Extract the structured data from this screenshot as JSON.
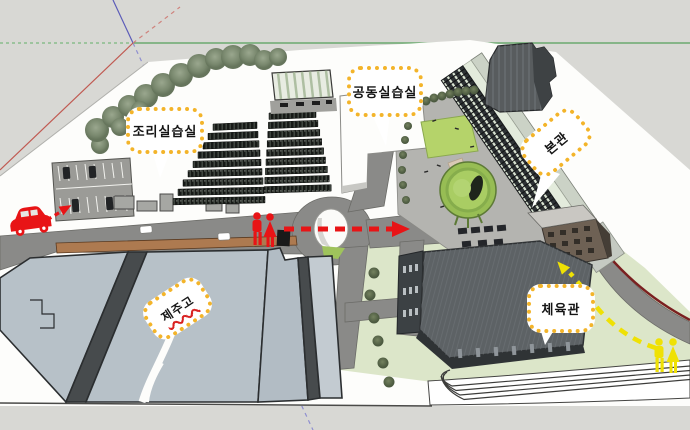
{
  "callouts": {
    "cooking_lab": {
      "label": "조리실습실"
    },
    "joint_lab": {
      "label": "공동실습실"
    },
    "main_building": {
      "label": "본관"
    },
    "jeju_high": {
      "label": "제주고"
    },
    "gym": {
      "label": "체육관"
    }
  },
  "routes": {
    "vehicle": {
      "icon": "car-icon",
      "color": "#e81416",
      "style": "dashed-arrow"
    },
    "pedestrian_main": {
      "icon": "pedestrians-icon",
      "color": "#e81416",
      "style": "dashed-arrow"
    },
    "pedestrian_gym": {
      "icon": "pedestrians-icon",
      "color": "#efe104",
      "style": "dashed-arrow"
    }
  },
  "colors": {
    "background": "#d8d8d4",
    "ground": "#ffffff",
    "road": "#8a8a88",
    "plaza": "#b4b4b0",
    "sidewalk_brown": "#ad7a50",
    "roof_blue_gray": "#b7c1c8",
    "lawn_light": "#dce6c9",
    "lawn_bright": "#b5d36a",
    "gym_roof": "#5d6265",
    "building_dark": "#2d3134",
    "callout_border": "#f3b42a",
    "callout_bg": "#ffffff",
    "route_red": "#e81416",
    "route_yellow": "#efe104",
    "road_edge_dark_red": "#7a2020",
    "axis_green": "#55a05a",
    "axis_red": "#c05a52",
    "axis_blue": "#5c5cb8"
  }
}
